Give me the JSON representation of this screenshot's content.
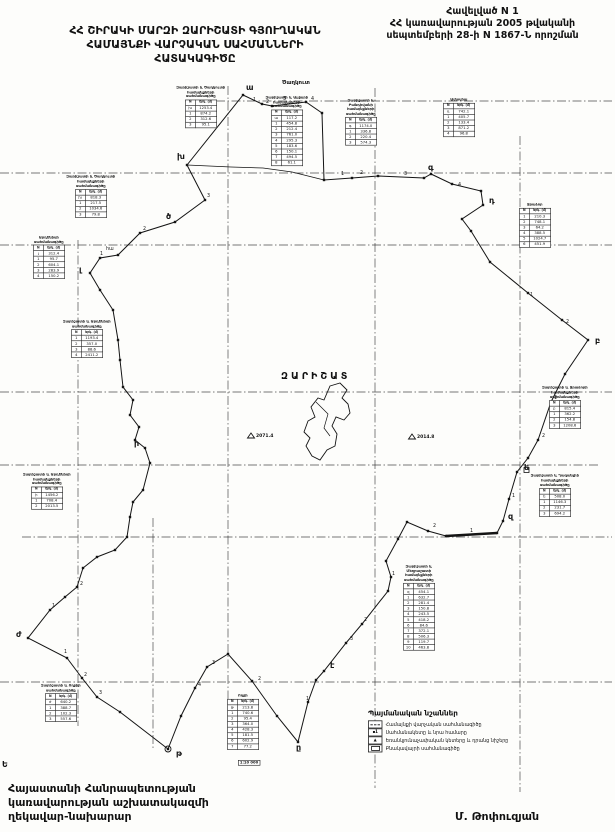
{
  "header": {
    "appendix_line1": "Հավելված N 1",
    "appendix_line2": "ՀՀ կառավարության 2005 թվականի",
    "appendix_line3": "սեպտեմբերի 28-ի N 1867-Ն որոշման",
    "title_line1": "ՀՀ ՇԻՐԱԿԻ ՄԱՐԶԻ ԶԱՐԻՇԱՏԻ ԳՅՈՒՂԱԿԱՆ",
    "title_line2": "ՀԱՄԱՅՆՔԻ ՎԱՐՉԱԿԱՆ ՍԱՀՄԱՆՆԵՐԻ",
    "title_line3": "ՀԱՏԱԿԱԳԻԾԸ"
  },
  "footer": {
    "official_line1": "Հայաստանի Հանրապետության",
    "official_line2": "կառավարության աշխատակազմի",
    "official_line3": "ղեկավար-նախարար",
    "signature": "Մ. Թոփուզյան",
    "stray_mark": "Ե",
    "scale_stamp": "1:10 000"
  },
  "map": {
    "community_name": "ԶԱՐԻՇԱՏ",
    "colors": {
      "ink": "#141414",
      "grid": "#2e2e2e",
      "paper": "#fdfdfb"
    },
    "grid": {
      "h": [
        {
          "y": 101,
          "x1": 185,
          "x2": 612
        },
        {
          "y": 173,
          "x1": 0,
          "x2": 612
        },
        {
          "y": 245,
          "x1": 0,
          "x2": 612
        },
        {
          "y": 392,
          "x1": 0,
          "x2": 612
        },
        {
          "y": 465,
          "x1": 0,
          "x2": 598
        },
        {
          "y": 537,
          "x1": 22,
          "x2": 612
        },
        {
          "y": 682,
          "x1": 0,
          "x2": 612
        }
      ],
      "v": [
        {
          "x": 78,
          "y1": 240,
          "y2": 726
        },
        {
          "x": 153,
          "y1": 518,
          "y2": 748
        },
        {
          "x": 228,
          "y1": 86,
          "y2": 750
        },
        {
          "x": 375,
          "y1": 88,
          "y2": 788
        },
        {
          "x": 520,
          "y1": 136,
          "y2": 792
        }
      ]
    },
    "boundary": [
      [
        243,
        95
      ],
      [
        262,
        104
      ],
      [
        272,
        106
      ],
      [
        306,
        102
      ],
      [
        322,
        113
      ],
      [
        324,
        180
      ],
      [
        352,
        178
      ],
      [
        378,
        176
      ],
      [
        424,
        178
      ],
      [
        431,
        174
      ],
      [
        452,
        184
      ],
      [
        481,
        191
      ],
      [
        483,
        205
      ],
      [
        462,
        219
      ],
      [
        471,
        231
      ],
      [
        490,
        262
      ],
      [
        528,
        293
      ],
      [
        562,
        320
      ],
      [
        588,
        340
      ],
      [
        565,
        374
      ],
      [
        551,
        402
      ],
      [
        538,
        440
      ],
      [
        528,
        458
      ],
      [
        517,
        472
      ],
      [
        509,
        499
      ],
      [
        503,
        521
      ],
      [
        497,
        533
      ],
      [
        446,
        536
      ],
      [
        428,
        531
      ],
      [
        407,
        522
      ],
      [
        398,
        539
      ],
      [
        386,
        561
      ],
      [
        391,
        577
      ],
      [
        388,
        591
      ],
      [
        362,
        624
      ],
      [
        346,
        643
      ],
      [
        324,
        671
      ],
      [
        316,
        680
      ],
      [
        308,
        702
      ],
      [
        298,
        742
      ],
      [
        277,
        716
      ],
      [
        252,
        681
      ],
      [
        228,
        654
      ],
      [
        207,
        667
      ],
      [
        195,
        688
      ],
      [
        181,
        716
      ],
      [
        168,
        749
      ],
      [
        120,
        712
      ],
      [
        97,
        697
      ],
      [
        82,
        678
      ],
      [
        67,
        658
      ],
      [
        28,
        638
      ],
      [
        50,
        610
      ],
      [
        65,
        597
      ],
      [
        77,
        587
      ],
      [
        83,
        568
      ],
      [
        97,
        557
      ],
      [
        115,
        550
      ],
      [
        127,
        537
      ],
      [
        130,
        517
      ],
      [
        133,
        502
      ],
      [
        143,
        490
      ],
      [
        150,
        463
      ],
      [
        145,
        448
      ],
      [
        135,
        440
      ],
      [
        139,
        427
      ],
      [
        130,
        415
      ],
      [
        133,
        400
      ],
      [
        123,
        387
      ],
      [
        120,
        360
      ],
      [
        118,
        340
      ],
      [
        113,
        310
      ],
      [
        100,
        290
      ],
      [
        90,
        273
      ],
      [
        100,
        258
      ],
      [
        118,
        255
      ],
      [
        140,
        233
      ],
      [
        175,
        222
      ],
      [
        205,
        200
      ],
      [
        187,
        165
      ]
    ],
    "extra_line": [
      [
        187,
        165
      ],
      [
        231,
        167
      ],
      [
        263,
        168
      ],
      [
        292,
        172
      ],
      [
        324,
        180
      ]
    ],
    "thick_segment": [
      [
        446,
        536
      ],
      [
        497,
        533
      ]
    ],
    "village_outline": [
      [
        330,
        386
      ],
      [
        340,
        383
      ],
      [
        347,
        390
      ],
      [
        342,
        398
      ],
      [
        348,
        404
      ],
      [
        350,
        413
      ],
      [
        344,
        420
      ],
      [
        336,
        417
      ],
      [
        332,
        426
      ],
      [
        337,
        434
      ],
      [
        335,
        446
      ],
      [
        327,
        450
      ],
      [
        320,
        460
      ],
      [
        312,
        456
      ],
      [
        306,
        446
      ],
      [
        310,
        438
      ],
      [
        304,
        432
      ],
      [
        308,
        421
      ],
      [
        315,
        417
      ],
      [
        311,
        407
      ],
      [
        318,
        398
      ],
      [
        324,
        400
      ]
    ],
    "village_inner": [
      [
        316,
        402
      ],
      [
        328,
        414
      ],
      [
        324,
        428
      ],
      [
        330,
        436
      ]
    ],
    "vertices": [
      {
        "label": "ա",
        "x": 246,
        "y": 90
      },
      {
        "label": "գ",
        "x": 428,
        "y": 170
      },
      {
        "label": "դ",
        "x": 489,
        "y": 203
      },
      {
        "label": "բ",
        "x": 595,
        "y": 343
      },
      {
        "label": "ե",
        "x": 524,
        "y": 470
      },
      {
        "label": "զ",
        "x": 508,
        "y": 519
      },
      {
        "label": "է",
        "x": 330,
        "y": 668
      },
      {
        "label": "ը",
        "x": 296,
        "y": 750
      },
      {
        "label": "թ",
        "x": 176,
        "y": 756
      },
      {
        "label": "ժ",
        "x": 16,
        "y": 637
      },
      {
        "label": "ի",
        "x": 134,
        "y": 446
      },
      {
        "label": "լ",
        "x": 79,
        "y": 272
      },
      {
        "label": "խ",
        "x": 177,
        "y": 159
      },
      {
        "label": "ծ",
        "x": 166,
        "y": 219
      }
    ],
    "segment_numbers": [
      {
        "t": "1",
        "x": 253,
        "y": 101
      },
      {
        "t": "2",
        "x": 266,
        "y": 103
      },
      {
        "t": "3",
        "x": 283,
        "y": 100
      },
      {
        "t": "4",
        "x": 311,
        "y": 100
      },
      {
        "t": "1",
        "x": 341,
        "y": 175
      },
      {
        "t": "2",
        "x": 360,
        "y": 174
      },
      {
        "t": "3",
        "x": 404,
        "y": 175
      },
      {
        "t": "4",
        "x": 458,
        "y": 186
      },
      {
        "t": "1",
        "x": 530,
        "y": 296
      },
      {
        "t": "2",
        "x": 566,
        "y": 323
      },
      {
        "t": "1",
        "x": 554,
        "y": 399
      },
      {
        "t": "2",
        "x": 542,
        "y": 437
      },
      {
        "t": "1",
        "x": 512,
        "y": 497
      },
      {
        "t": "1",
        "x": 470,
        "y": 532
      },
      {
        "t": "2",
        "x": 433,
        "y": 527
      },
      {
        "t": "1",
        "x": 392,
        "y": 575
      },
      {
        "t": "2",
        "x": 364,
        "y": 621
      },
      {
        "t": "3",
        "x": 350,
        "y": 640
      },
      {
        "t": "1",
        "x": 306,
        "y": 700
      },
      {
        "t": "2",
        "x": 258,
        "y": 680
      },
      {
        "t": "3",
        "x": 212,
        "y": 664
      },
      {
        "t": "4",
        "x": 198,
        "y": 686
      },
      {
        "t": "1",
        "x": 64,
        "y": 653
      },
      {
        "t": "2",
        "x": 84,
        "y": 676
      },
      {
        "t": "3",
        "x": 99,
        "y": 694
      },
      {
        "t": "1",
        "x": 52,
        "y": 607
      },
      {
        "t": "2",
        "x": 80,
        "y": 585
      },
      {
        "t": "1",
        "x": 100,
        "y": 255
      },
      {
        "t": "2",
        "x": 143,
        "y": 230
      },
      {
        "t": "3",
        "x": 207,
        "y": 197
      },
      {
        "t": "հա",
        "x": 106,
        "y": 250
      }
    ],
    "neighbor_labels": [
      {
        "t": "Ծաղկուտ",
        "x": 282,
        "y": 84
      }
    ],
    "triangulation_points": [
      {
        "x": 251,
        "y": 437,
        "label": "2071.4"
      },
      {
        "x": 412,
        "y": 438,
        "label": "2014.8"
      }
    ],
    "markers": {
      "start_circle": {
        "x": 168,
        "y": 749
      },
      "open_square": {
        "x": 524,
        "y": 470
      }
    },
    "tables": [
      {
        "x": 176,
        "y": 86,
        "title": [
          "Զարիշատի և Ծաղկուտի",
          "համայնքների սահմանագիծը"
        ],
        "rows": [
          [
            "խ",
            "1253.4"
          ],
          [
            "1",
            "874.2"
          ],
          [
            "2",
            "312.6"
          ],
          [
            "3",
            "95.1"
          ]
        ]
      },
      {
        "x": 262,
        "y": 96,
        "title": [
          "Զարիշատի և Ալվարի",
          "համայնքների սահմանագիծը"
        ],
        "rows": [
          [
            "ա",
            "117.2"
          ],
          [
            "1",
            "454.8"
          ],
          [
            "2",
            "212.4"
          ],
          [
            "3",
            "761.0"
          ],
          [
            "4",
            "295.3"
          ],
          [
            "5",
            "183.6"
          ],
          [
            "6",
            "150.1"
          ],
          [
            "7",
            "494.5"
          ],
          [
            "8",
            "61.1"
          ]
        ]
      },
      {
        "x": 336,
        "y": 99,
        "title": [
          "Զարիշատի և Բանդիվանի",
          "համայնքների",
          "սահմանագիծը"
        ],
        "rows": [
          [
            "գ",
            "1174.0"
          ],
          [
            "1",
            "336.8"
          ],
          [
            "2",
            "220.4"
          ],
          [
            "3",
            "574.3"
          ]
        ]
      },
      {
        "x": 434,
        "y": 98,
        "title": [
          "Ամասիա"
        ],
        "rows": [
          [
            "դ",
            "742.1"
          ],
          [
            "1",
            "405.7"
          ],
          [
            "2",
            "133.4"
          ],
          [
            "3",
            "871.2"
          ],
          [
            "4",
            "96.8"
          ]
        ]
      },
      {
        "x": 510,
        "y": 203,
        "title": [
          "Ջրաձոր"
        ],
        "rows": [
          [
            "1",
            "210.3"
          ],
          [
            "2",
            "748.1"
          ],
          [
            "3",
            "64.2"
          ],
          [
            "4",
            "388.5"
          ],
          [
            "5",
            "1024.7"
          ],
          [
            "6",
            "451.9"
          ]
        ]
      },
      {
        "x": 540,
        "y": 386,
        "title": [
          "Զարիշատի և Ջրաձորի",
          "համայնքների",
          "սահմանագիծը"
        ],
        "rows": [
          [
            "բ",
            "815.4"
          ],
          [
            "1",
            "362.2"
          ],
          [
            "2",
            "154.8"
          ],
          [
            "3",
            "1208.6"
          ]
        ]
      },
      {
        "x": 530,
        "y": 474,
        "title": [
          "Զարիշատի և Ղազանչիի",
          "համայնքների",
          "սահմանագիծը"
        ],
        "rows": [
          [
            "ե",
            "508.0"
          ],
          [
            "1",
            "1146.3"
          ],
          [
            "2",
            "231.7"
          ],
          [
            "3",
            "694.2"
          ]
        ]
      },
      {
        "x": 394,
        "y": 565,
        "title": [
          "Զարիշատի և Մեղրաշատի",
          "համայնքների",
          "սահմանագիծը"
        ],
        "rows": [
          [
            "զ",
            "454.1"
          ],
          [
            "1",
            "632.7"
          ],
          [
            "2",
            "281.4"
          ],
          [
            "3",
            "150.8"
          ],
          [
            "4",
            "243.5"
          ],
          [
            "5",
            "418.2"
          ],
          [
            "6",
            "84.6"
          ],
          [
            "7",
            "372.1"
          ],
          [
            "8",
            "506.3"
          ],
          [
            "9",
            "119.7"
          ],
          [
            "10",
            "463.8"
          ]
        ]
      },
      {
        "x": 22,
        "y": 473,
        "title": [
          "Զարիշատի և Արդենիսի",
          "համայնքների սահմանագիծը"
        ],
        "rows": [
          [
            "ի",
            "1456.2"
          ],
          [
            "1",
            "708.4"
          ],
          [
            "2",
            "2013.5"
          ]
        ]
      },
      {
        "x": 36,
        "y": 684,
        "title": [
          "Զարիշատի և Ողջիի",
          "սահմանագիծը"
        ],
        "rows": [
          [
            "ժ",
            "640.2"
          ],
          [
            "1",
            "388.7"
          ],
          [
            "2",
            "102.3"
          ],
          [
            "3",
            "557.6"
          ]
        ]
      },
      {
        "x": 218,
        "y": 694,
        "title": [
          "Ողջի"
        ],
        "rows": [
          [
            "թ",
            "213.8"
          ],
          [
            "1",
            "740.6"
          ],
          [
            "2",
            "95.4"
          ],
          [
            "3",
            "364.0"
          ],
          [
            "4",
            "428.3"
          ],
          [
            "5",
            "181.5"
          ],
          [
            "6",
            "602.9"
          ],
          [
            "7",
            "77.2"
          ]
        ]
      },
      {
        "x": 24,
        "y": 236,
        "title": [
          "Արդենիսի սահմանագիծը"
        ],
        "rows": [
          [
            "լ",
            "312.4"
          ],
          [
            "1",
            "95.7"
          ],
          [
            "2",
            "604.1"
          ],
          [
            "3",
            "283.9"
          ],
          [
            "4",
            "150.2"
          ]
        ]
      },
      {
        "x": 66,
        "y": 175,
        "title": [
          "Զարիշատի և Ծաղկուտի",
          "համայնքների",
          "սահմանագիծը"
        ],
        "rows": [
          [
            "խ",
            "818.3"
          ],
          [
            "1",
            "217.5"
          ],
          [
            "2",
            "1034.6"
          ],
          [
            "3",
            "79.8"
          ]
        ]
      },
      {
        "x": 62,
        "y": 320,
        "title": [
          "Զարիշատի և Արդենիսի",
          "սահմանագիծը"
        ],
        "rows": [
          [
            "1",
            "1193.4"
          ],
          [
            "2",
            "357.0"
          ],
          [
            "3",
            "88.6"
          ],
          [
            "4",
            "2411.2"
          ]
        ]
      }
    ],
    "table_col_headers": [
      "N",
      "երկ. (մ)"
    ],
    "legend": {
      "title": "Պայմանական նշաններ",
      "items": [
        {
          "sym": "dashline",
          "label": "Համայնքի վարչական սահմանագիծը"
        },
        {
          "sym": "point",
          "label": "Սահմանակետը և նրա համարը"
        },
        {
          "sym": "triangle",
          "label": "Եռանկյունաչափական կետերը և դրանց նիշերը"
        },
        {
          "sym": "rect",
          "label": "Բնակավայրի սահմանագիծը"
        }
      ]
    }
  }
}
